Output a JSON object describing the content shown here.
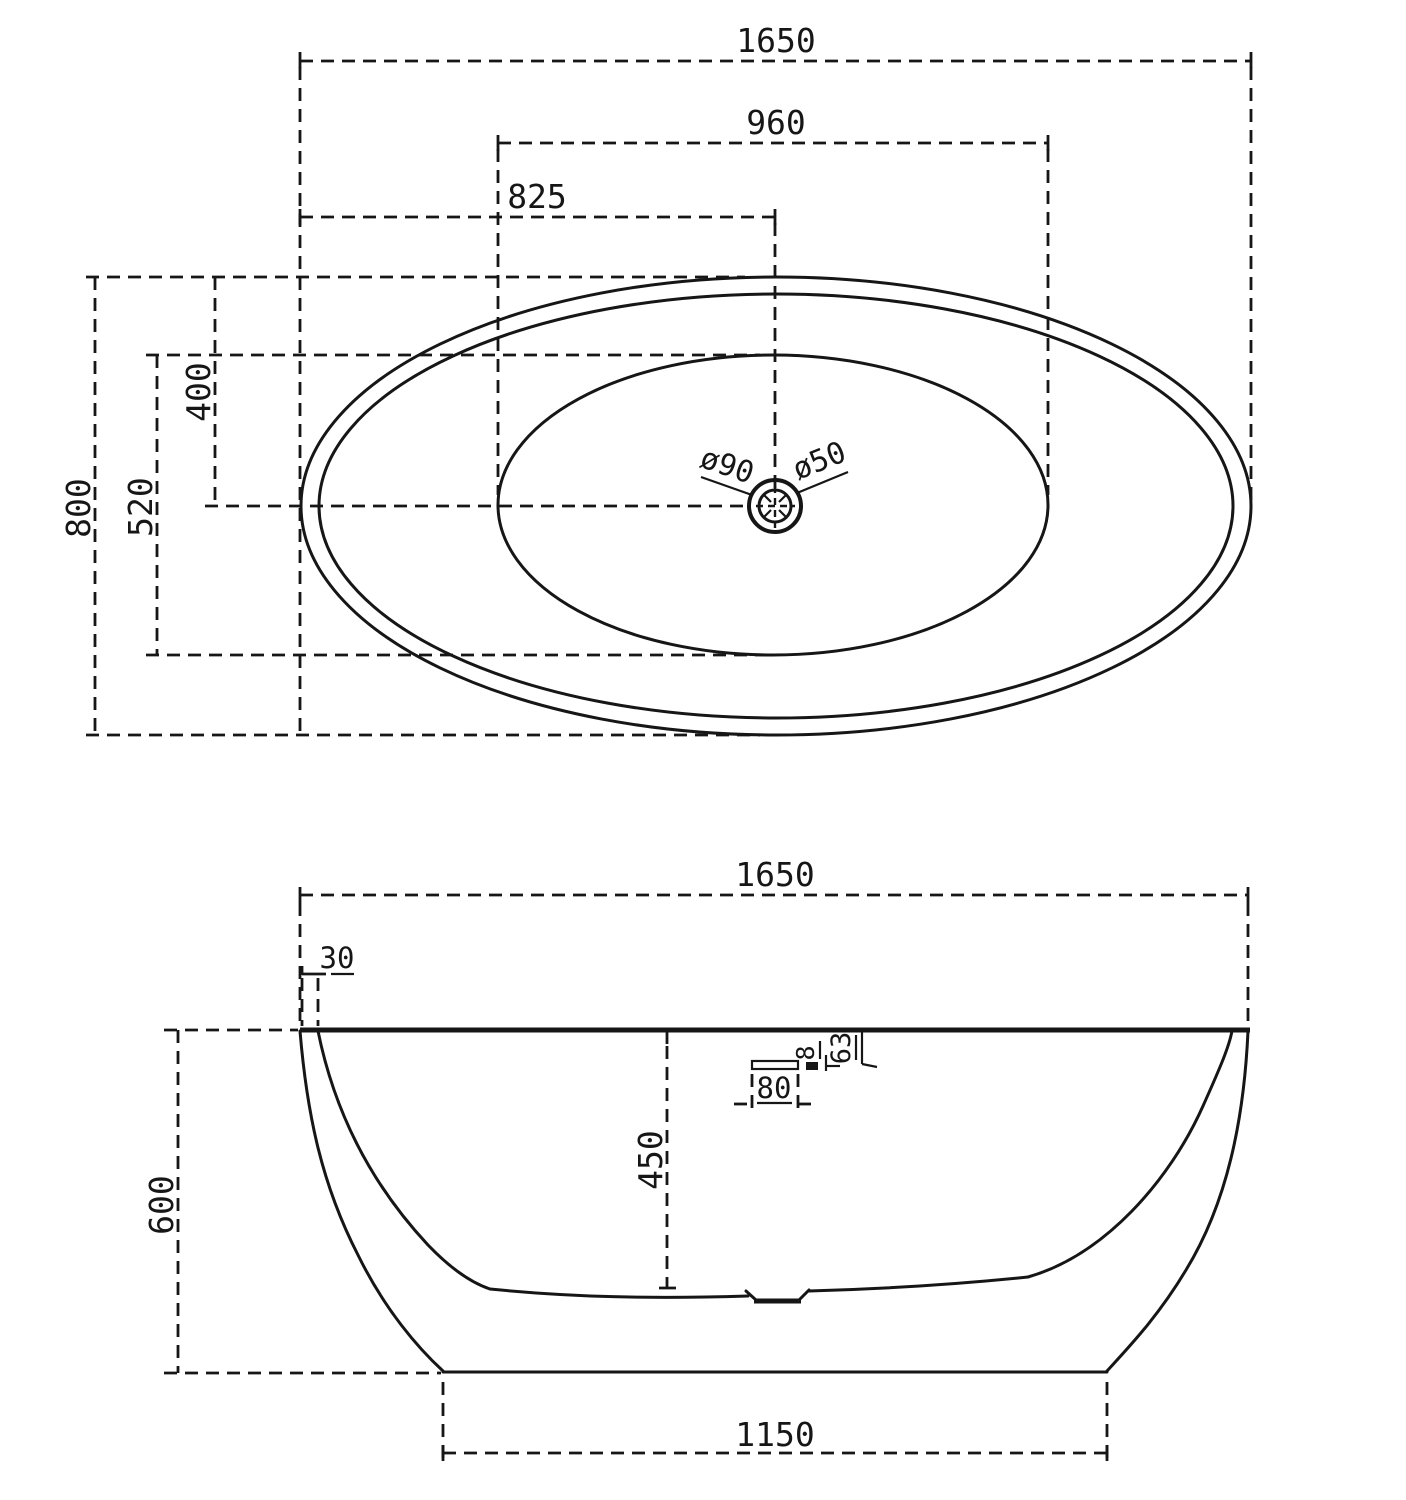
{
  "drawing_title": "bathtub dimension drawing",
  "top_view": {
    "dims": {
      "overall_length": "1650",
      "inner_basin_length": "960",
      "drain_offset_from_left": "825",
      "drain_offset_from_top": "400",
      "inner_basin_width": "520",
      "overall_width": "800",
      "drain_outer_diameter": "ø90",
      "drain_waste_diameter": "ø50"
    }
  },
  "side_view": {
    "dims": {
      "overall_length": "1650",
      "rim_wall_thickness": "30",
      "overall_height": "600",
      "inner_depth": "450",
      "overflow_slot_width": "80",
      "overflow_slot_height": "8",
      "overflow_offset_from_top": "63",
      "base_length": "1150"
    }
  }
}
